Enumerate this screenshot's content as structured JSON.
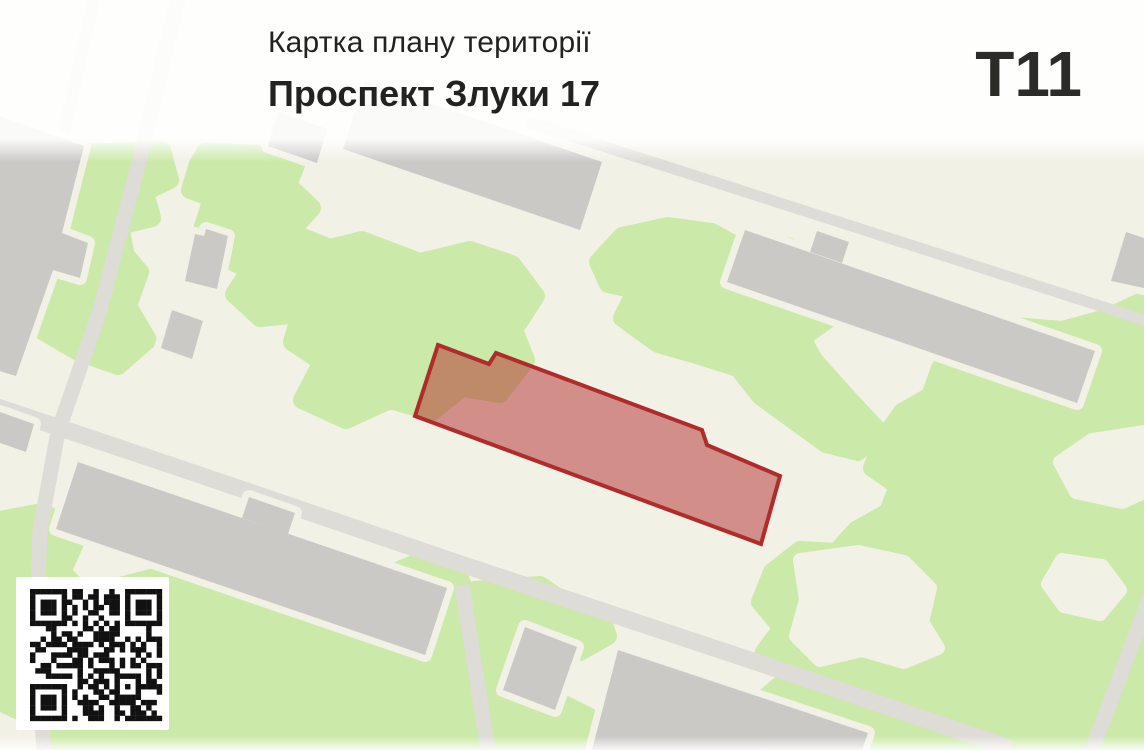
{
  "header": {
    "title": "Картка плану території",
    "address": "Проспект Злуки 17",
    "code": "T11"
  },
  "map": {
    "highlighted_parcel_label": "Проспект Злуки 17",
    "qr_modules": 25
  },
  "colors": {
    "background": "#f2f1e6",
    "green_area": "#cbe9a8",
    "building": "#cbc9c6",
    "road": "#dedcd6",
    "parcel_fill": "rgba(178,43,43,0.5)",
    "parcel_stroke": "#b02c2c",
    "text": "#222220"
  }
}
